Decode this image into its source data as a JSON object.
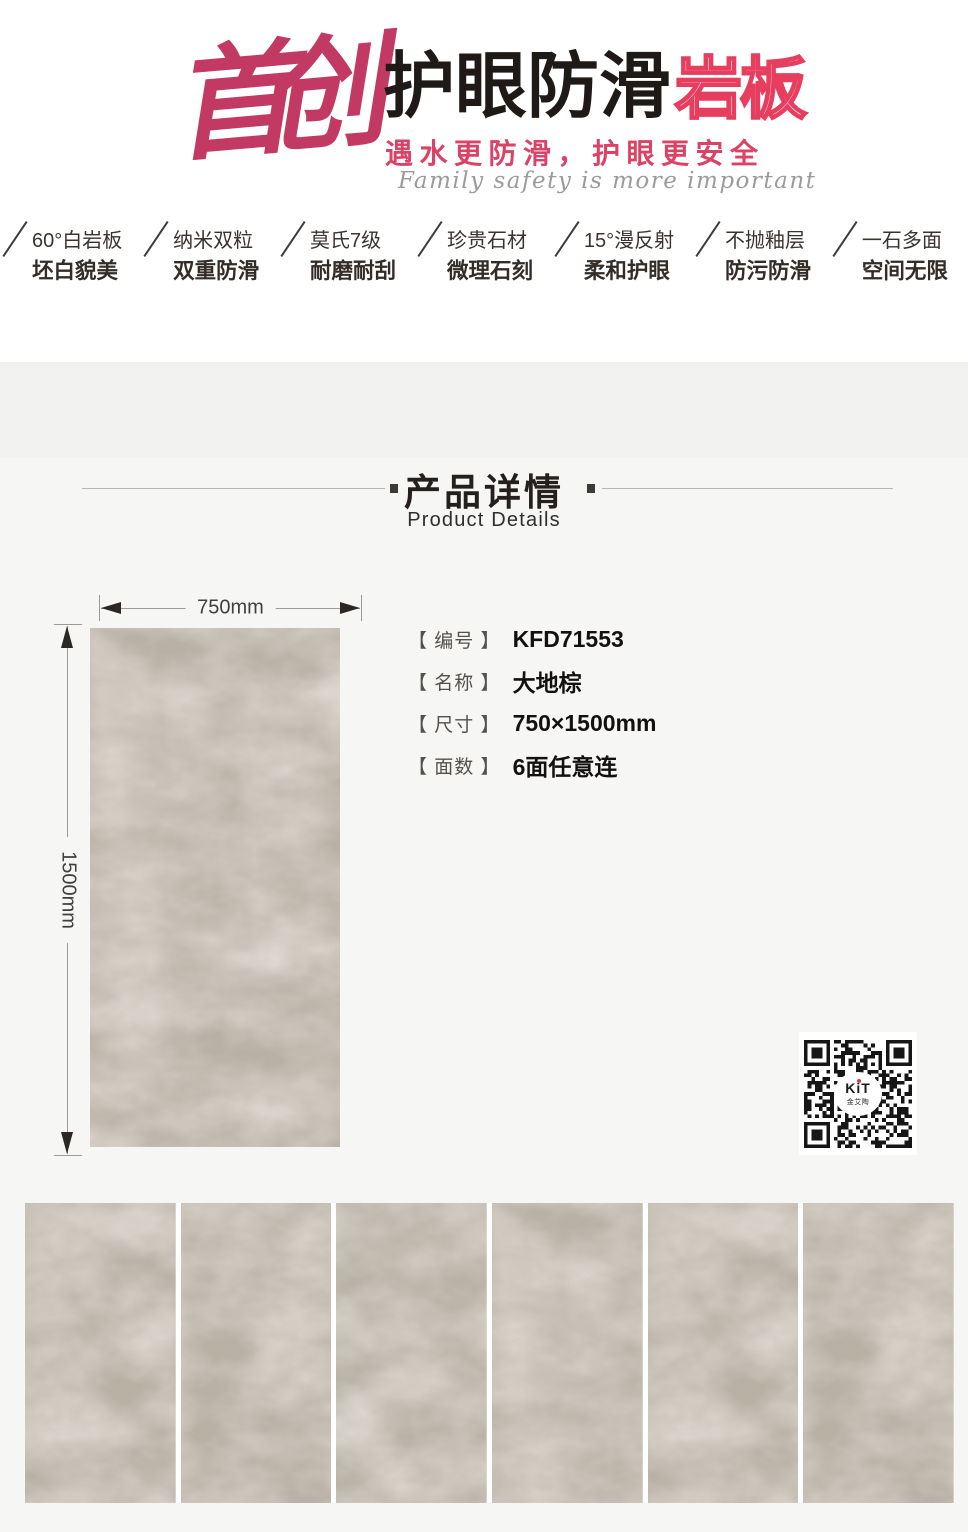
{
  "header": {
    "brand_calligraphy": "首创",
    "title_black": "护眼防滑",
    "title_outline": "岩板",
    "tagline": "遇水更防滑，护眼更安全",
    "tagline_en": "Family safety is more important"
  },
  "features": [
    {
      "line1": "60°白岩板",
      "line2": "坯白貌美"
    },
    {
      "line1": "纳米双粒",
      "line2": "双重防滑"
    },
    {
      "line1": "莫氏7级",
      "line2": "耐磨耐刮"
    },
    {
      "line1": "珍贵石材",
      "line2": "微理石刻"
    },
    {
      "line1": "15°漫反射",
      "line2": "柔和护眼"
    },
    {
      "line1": "不抛釉层",
      "line2": "防污防滑"
    },
    {
      "line1": "一石多面",
      "line2": "空间无限"
    }
  ],
  "section": {
    "title": "产品详情",
    "subtitle": "Product Details"
  },
  "product": {
    "width_label": "750mm",
    "height_label": "1500mm",
    "specs": [
      {
        "label": "【 编号 】",
        "value": "KFD71553"
      },
      {
        "label": "【 名称 】",
        "value": "大地棕"
      },
      {
        "label": "【 尺寸 】",
        "value": "750×1500mm"
      },
      {
        "label": "【 面数 】",
        "value": "6面任意连"
      }
    ]
  },
  "qr": {
    "logo_k": "K",
    "logo_i": "i",
    "logo_t": "T",
    "logo_subtext": "金艾陶"
  },
  "colors": {
    "brand_pink": "#c23a64",
    "accent_pink": "#e73e5f",
    "tile_base": "#b9b0a4",
    "band_bg": "#f2f2f1",
    "body_bg": "#f6f6f5"
  }
}
